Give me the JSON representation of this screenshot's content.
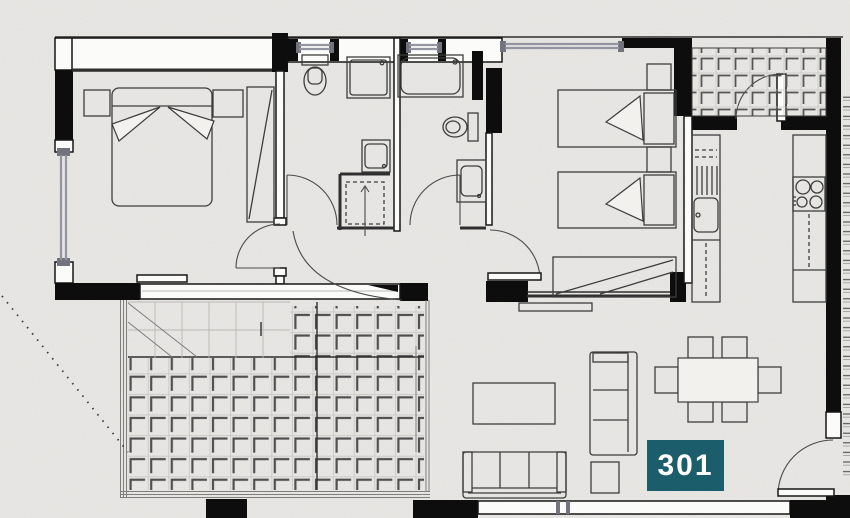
{
  "unit_badge": {
    "label": "301"
  },
  "colors": {
    "badge_bg": "#1b5d6b",
    "badge_text": "#ffffff",
    "wall": "#0d0d0d",
    "line": "#2f2f2f",
    "furniture_line": "#3d3d3d",
    "window_gray": "#9295a0",
    "tile_mark": "#4f4f4f",
    "paper": "#eae9e6"
  },
  "symbols": [
    "double-bed",
    "single-bed",
    "nightstand",
    "wardrobe",
    "toilet",
    "shower",
    "bathtub",
    "washbasin",
    "washing-machine",
    "kitchen-sink",
    "cooktop",
    "sofa",
    "coffee-table",
    "side-table",
    "dining-table",
    "dining-chair",
    "door-swing",
    "window",
    "terrace-paving"
  ]
}
